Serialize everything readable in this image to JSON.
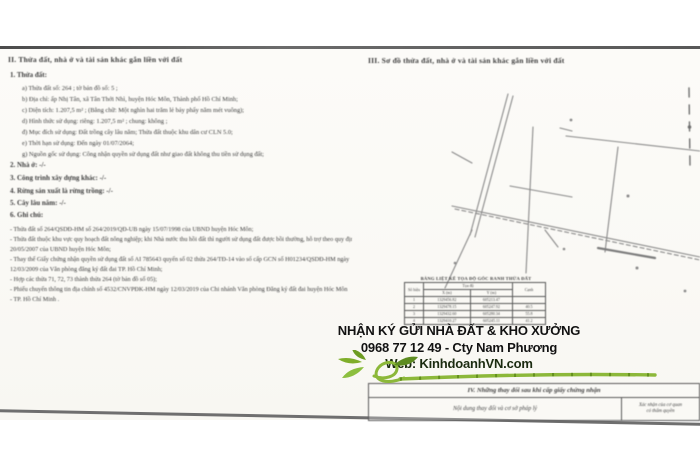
{
  "ad": {
    "line1": "NHẬN KÝ GỬI NHÀ ĐẤT & KHO XƯỞNG",
    "line2": "0968 77 12 49 - Cty Nam Phương",
    "line3": "Web: KinhdoanhVN.com",
    "accent_green": "#85b52f"
  },
  "left": {
    "title": "II. Thửa đất, nhà ở và tài sản khác gắn liền với đất",
    "sec1": "1. Thửa đất:",
    "items": [
      "a) Thửa đất số: 264 ;             tờ bản đồ số: 5 ;",
      "b) Địa chỉ:    ấp Nhị Tân, xã Tân Thới Nhì, huyện Hóc Môn, Thành phố Hồ Chí Minh;",
      "c) Diện tích:   1.207,5 m² ;   (Bằng chữ: Một nghìn hai trăm lẻ bảy phẩy năm mét vuông);",
      "d) Hình thức sử dụng:    riêng:  1.207,5 m² ;   chung:  không ;",
      "đ) Mục đích sử dụng:    Đất trồng cây lâu năm;  Thửa đất thuộc khu dân cư  CLN 5.0;",
      "e) Thời hạn sử dụng:    Đến ngày 01/07/2064;",
      "g) Nguồn gốc sử dụng:   Công nhận quyền sử dụng đất như giao đất không thu tiền sử dụng đất;"
    ],
    "sections": [
      "2. Nhà ở:  -/-",
      "3. Công trình xây dựng khác:  -/-",
      "4. Rừng sản xuất là rừng trồng:  -/-",
      "5. Cây lâu năm:  -/-"
    ],
    "notes_title": "6. Ghi chú:",
    "notes": [
      "- Thửa đất số 264/QSDĐ-HM số 264/2019/QĐ-UB ngày 15/07/1998 của UBND huyện Hóc Môn;",
      "- Thửa đất thuộc khu vực quy hoạch đất nông nghiệp; khi Nhà nước thu hồi đất thì người sử dụng đất được bồi thường, hỗ trợ theo quy định tại  Công văn 2845/UBND ngày",
      "20/05/2007 của UBND huyện Hóc Môn;",
      "- Thay thế Giấy chứng nhận quyền sử dụng đất số AI 785643 quyển số 02 thửa 264/TĐ-14 vào sổ cấp GCN số H01234/QSDĐ-HM ngày",
      "12/03/2009 của Văn phòng đăng ký đất đai TP. Hồ Chí Minh;",
      "- Hợp các thửa 71, 72, 73 thành thửa 264 (tờ bản đồ số 05);",
      "- Phiếu chuyển thông tin địa chính số 4532/CNVPĐK-HM ngày 12/03/2019 của Chi nhánh Văn phòng Đăng ký đất đai  huyện Hóc Môn",
      "- TP.  Hồ  Chí  Minh ."
    ]
  },
  "right": {
    "title": "III. Sơ đồ thửa đất, nhà ở và tài sản khác gắn liền với đất",
    "table": {
      "title": "BẢNG LIỆT KÊ TỌA ĐỘ GÓC RANH THỬA ĐẤT",
      "col_point": "Số hiệu",
      "col_coords": "Tọa độ",
      "col_x": "X (m)",
      "col_y": "Y (m)",
      "col_edge": "Cạnh",
      "rows": [
        [
          "1",
          "1329456.82",
          "605213.47",
          ""
        ],
        [
          "2",
          "1329478.15",
          "605247.92",
          "40.5"
        ],
        [
          "3",
          "1329432.60",
          "605280.34",
          "55.8"
        ],
        [
          "4",
          "1329410.27",
          "605245.11",
          "41.2"
        ]
      ]
    },
    "changes": {
      "title": "IV. Những thay đổi sau khi cấp giấy chứng nhận",
      "left_header": "Nội dung thay đổi và cơ sở pháp lý",
      "right_header_line1": "Xác nhận của cơ quan",
      "right_header_line2": "có thẩm quyền"
    }
  }
}
